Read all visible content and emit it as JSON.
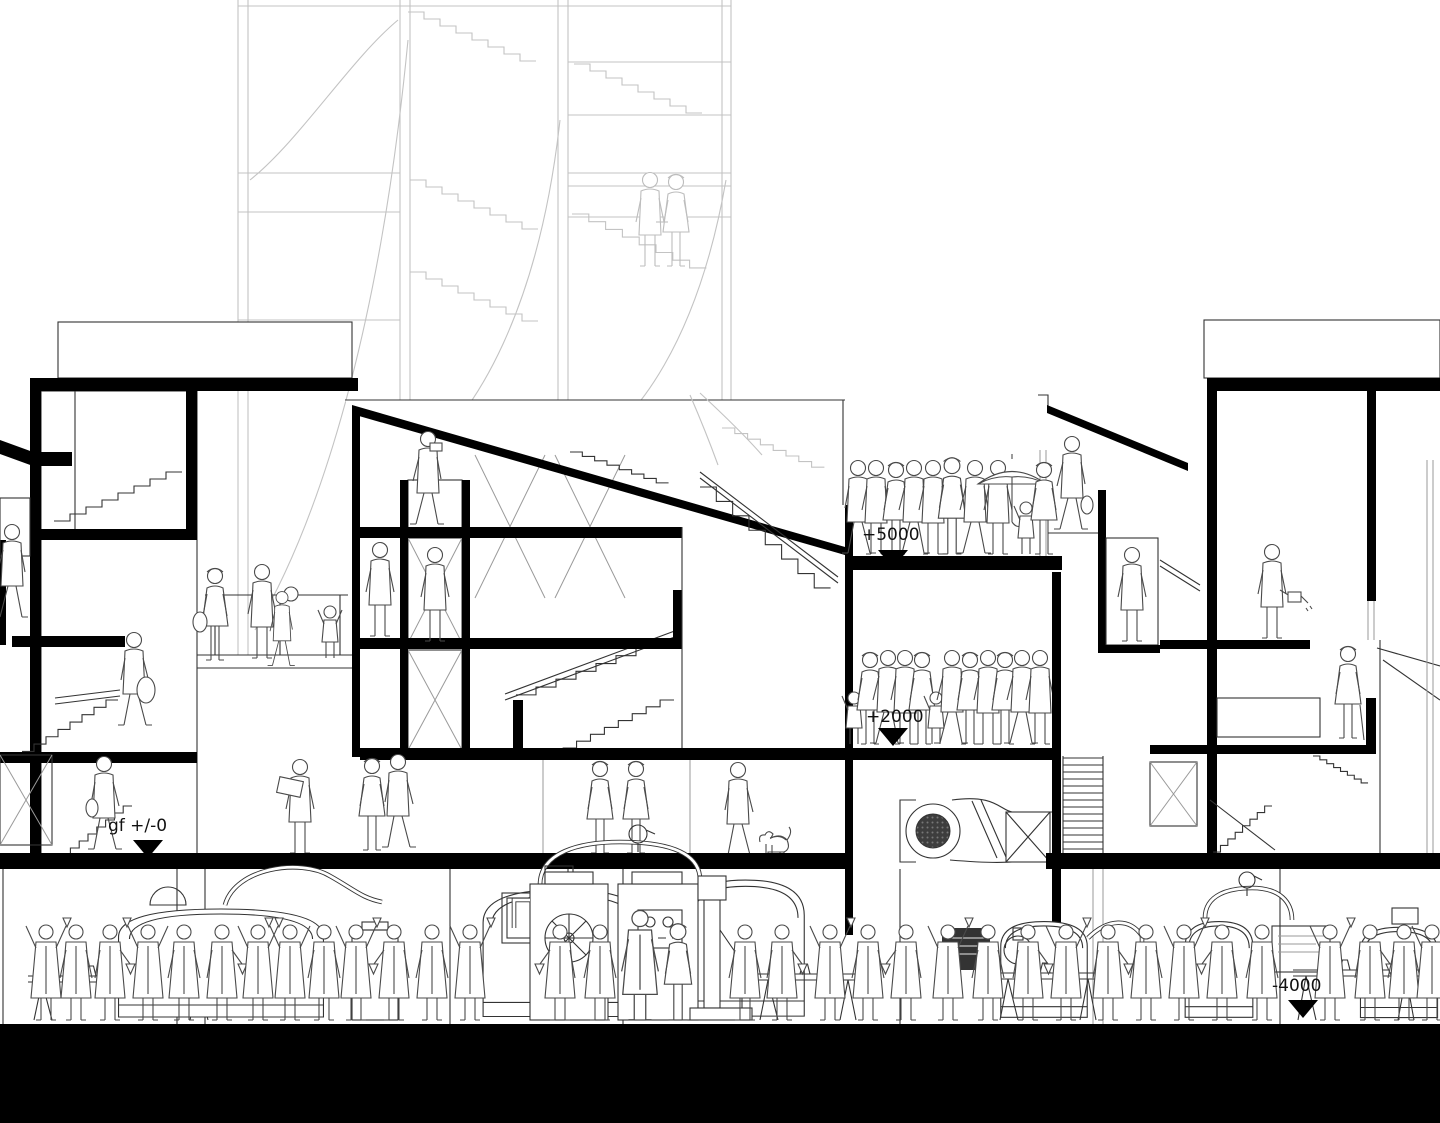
{
  "colors": {
    "ink": "#000000",
    "line": "#333333",
    "figure": "#4a4a4a",
    "tower": "#c3c3c3",
    "background": "#ffffff"
  },
  "levels": {
    "plus5000": {
      "label": "+5000",
      "marker": "down-triangle"
    },
    "plus2000": {
      "label": "+2000",
      "marker": "down-triangle"
    },
    "ground": {
      "label": "gf +/-0",
      "marker": "down-triangle"
    },
    "minus4000": {
      "label": "-4000",
      "marker": "down-triangle"
    }
  }
}
